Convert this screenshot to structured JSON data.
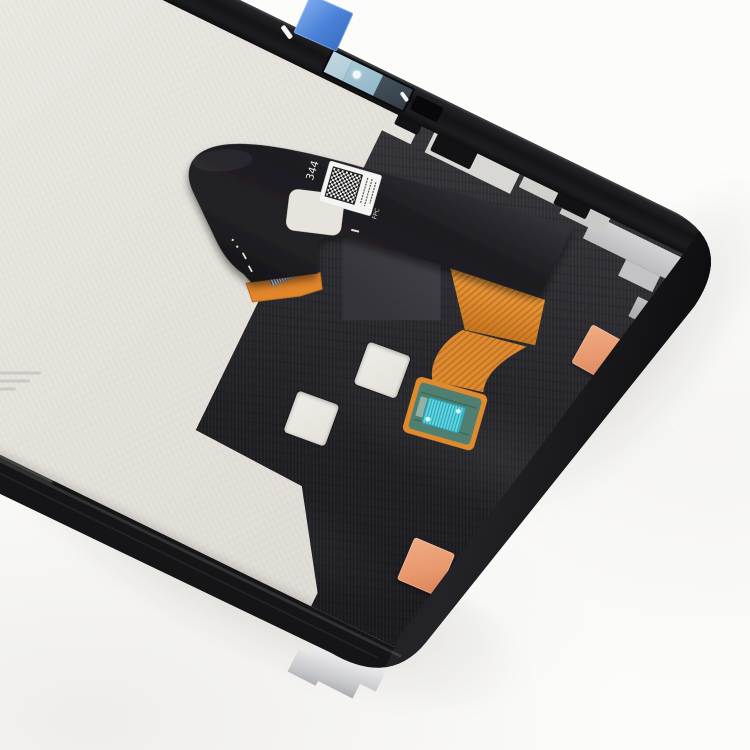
{
  "scene": {
    "title": "Tablet LCD Screen and Digitizer Full Assembly - replacement part (back side)",
    "description": "Top-down product photo of a tilted tablet display assembly on a white background: beige metal back plate, black frame edges, graphite film with cutout squares, U-shaped black flex cable with QR label and gold connector, copper trace fan leading to a teal PCB pad with a cyan chip, blue pull tab at the top edge, two orange square stickers and a silver bracket tab at the bottom edge"
  },
  "labels": {
    "flex_serial": "344",
    "flex_connector_code": "FPC"
  },
  "qr_label": {
    "kind": "data-matrix / QR sticker on flex cable",
    "micro_text_columns": 3
  },
  "colors": {
    "bg": "#fcfcfb",
    "plate": "#e7e4de",
    "frame": "#151517",
    "graphite": "#2b2a2f",
    "flex": "#1d1c20",
    "copper": "#e0892e",
    "copper_deep": "#b96f1e",
    "teal_pcb": "#507f72",
    "cyan_chip": "#5bd9e6",
    "blue_tape": "#4a82d8",
    "orange_sticker": "#e8996e",
    "bracket": "#c7c8cb",
    "qr_white": "#f4f4f2",
    "qr_black": "#161616"
  }
}
